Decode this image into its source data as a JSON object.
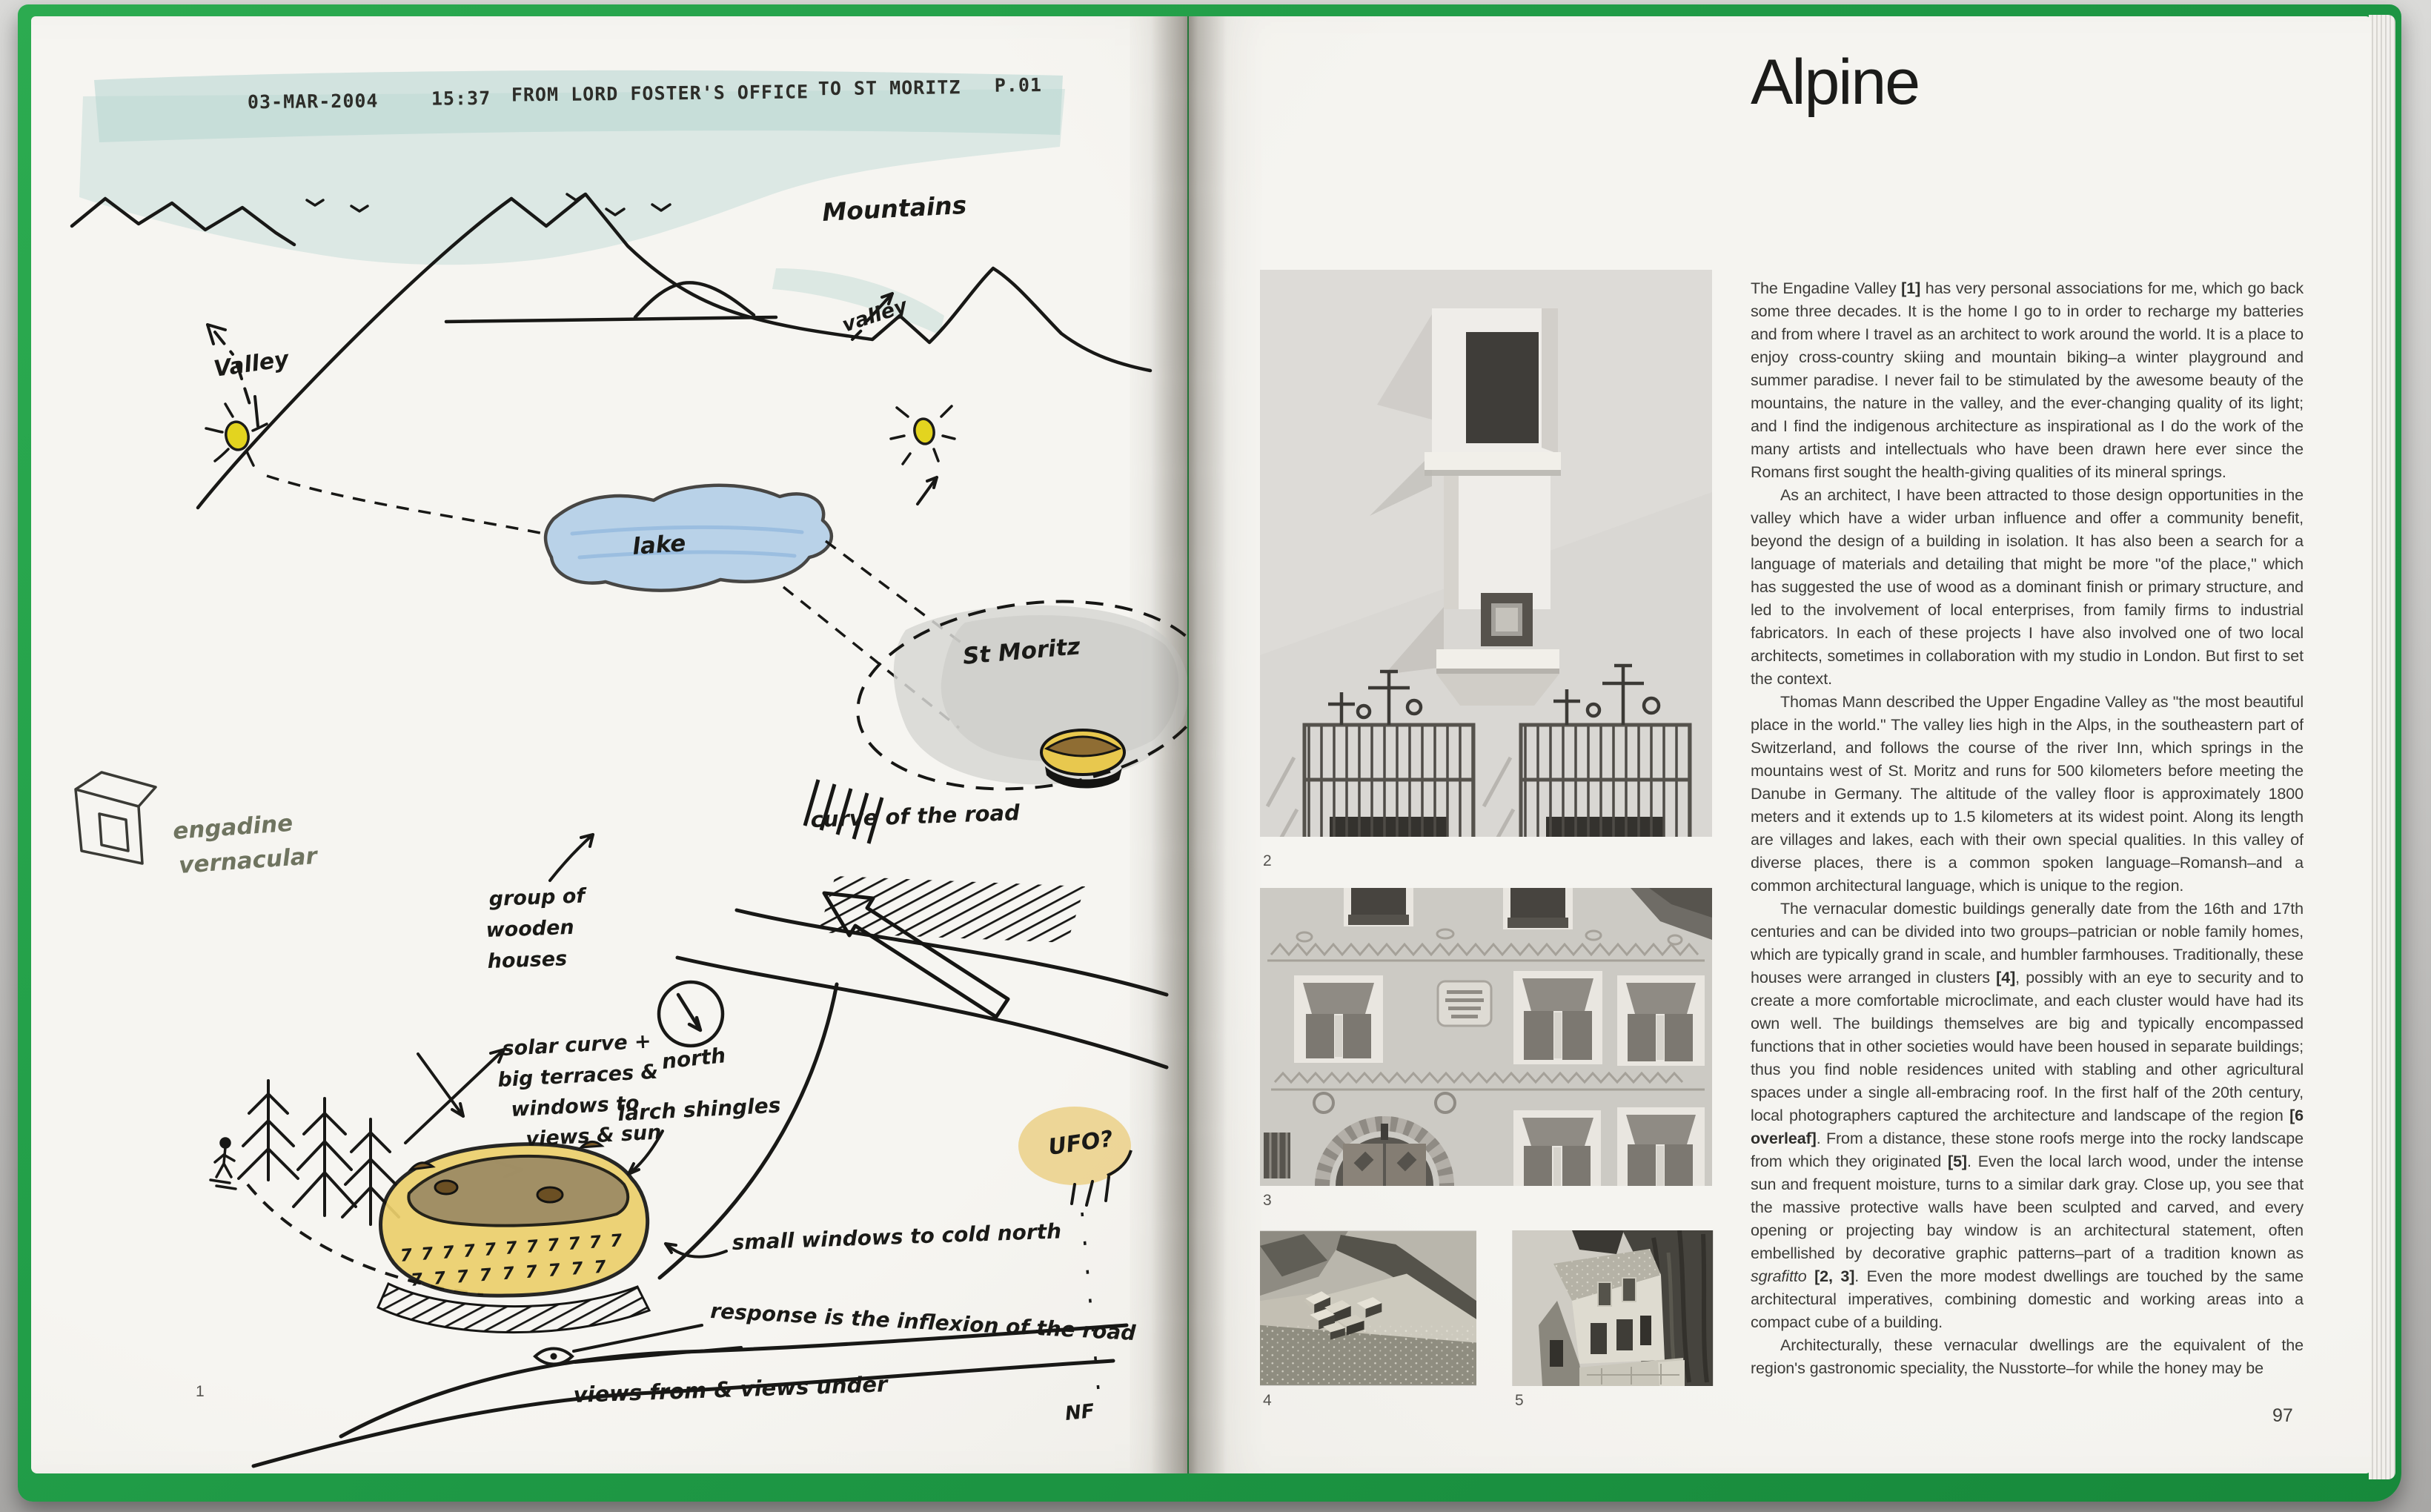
{
  "book": {
    "colors": {
      "cover_green": "#1f9a46",
      "fax_teal": "#aed2cd",
      "lake_blue": "#a9c9e6",
      "sun_yellow": "#e3d41f",
      "building_yellow": "#ecd06c",
      "ink_black": "#1a1a17",
      "ink_olive": "#6f7460"
    },
    "left_page": {
      "fax_header": {
        "date": "03-MAR-2004",
        "time": "15:37",
        "from": "FROM  LORD FOSTER'S OFFICE",
        "to": "TO  ST MORITZ",
        "page_code": "P.01"
      },
      "sketch_labels": {
        "mountains": "Mountains",
        "valley_right": "valley",
        "valley_left": "Valley",
        "lake": "lake",
        "st_moritz": "St Moritz",
        "engadine_line1": "engadine",
        "engadine_line2": "vernacular",
        "curve_of_road": "curve of the road",
        "group_line1": "group of",
        "group_line2": "wooden",
        "group_line3": "houses",
        "north": "north",
        "solar_line1": "solar curve +",
        "solar_line2": "big terraces &",
        "solar_line3": "windows to",
        "solar_line4": "views & sun",
        "larch": "larch shingles",
        "ufo": "UFO?",
        "small_windows": "small windows to cold north",
        "response": "response is the inflexion of the road",
        "views": "views from & views under",
        "initials": "NF",
        "window_marks_row1": "7 7 7 7 7 7 7 7 7 7 7",
        "window_marks_row2": "7 7 7 7 7 7 7 7 7"
      },
      "figure_number": "1"
    },
    "right_page": {
      "title": "Alpine",
      "figures": [
        {
          "number": "2"
        },
        {
          "number": "3"
        },
        {
          "number": "4"
        },
        {
          "number": "5"
        }
      ],
      "page_number": "97",
      "article": {
        "paragraphs": [
          [
            {
              "t": "The Engadine Valley "
            },
            {
              "t": "[1]",
              "b": true
            },
            {
              "t": " has very personal associations for me, which go back some three decades. It is the home I go to in order to recharge my batteries and from where I travel as an architect to work around the world. It is a place to enjoy cross-country skiing and mountain biking–a winter playground and summer paradise. I never fail to be stimulated by the awesome beauty of the mountains, the nature in the valley, and the ever-changing quality of its light; and I find the indigenous architecture as inspirational as I do the work of the many artists and intellectuals who have been drawn here ever since the Romans first sought the health-giving qualities of its mineral springs."
            }
          ],
          [
            {
              "t": "As an architect, I have been attracted to those design opportunities in the valley which have a wider urban influence and offer a community benefit, beyond the design of a building in isolation. It has also been a search for a language of materials and detailing that might be more \"of the place,\" which has suggested the use of wood as a dominant finish or primary structure, and led to the involvement of local enterprises, from family firms to industrial fabricators. In each of these projects I have also involved one of two local architects, sometimes in collaboration with my studio in London. But first to set the context."
            }
          ],
          [
            {
              "t": "Thomas Mann described the Upper Engadine Valley as \"the most beautiful place in the world.\" The valley lies high in the Alps, in the southeastern part of Switzerland, and follows the course of the river Inn, which springs in the mountains west of St. Moritz and runs for 500 kilometers before meeting the Danube in Germany. The altitude of the valley floor is approximately 1800 meters and it extends up to 1.5 kilometers at its widest point. Along its length are villages and lakes, each with their own special qualities. In this valley of diverse places, there is a common spoken language–Romansh–and a common architectural language, which is unique to the region."
            }
          ],
          [
            {
              "t": "The vernacular domestic buildings generally date from the 16th and 17th centuries and can be divided into two groups–patrician or noble family homes, which are typically grand in scale, and humbler farmhouses. Traditionally, these houses were arranged in clusters "
            },
            {
              "t": "[4]",
              "b": true
            },
            {
              "t": ", possibly with an eye to security and to create a more comfortable microclimate, and each cluster would have had its own well. The buildings themselves are big and typically encompassed functions that in other societies would have been housed in separate buildings; thus you find noble residences united with stabling and other agricultural spaces under a single all-embracing roof. In the first half of the 20th century, local photographers captured the architecture and landscape of the region "
            },
            {
              "t": "[6 overleaf]",
              "b": true
            },
            {
              "t": ". From a distance, these stone roofs merge into the rocky landscape from which they originated "
            },
            {
              "t": "[5]",
              "b": true
            },
            {
              "t": ". Even the local larch wood, under the intense sun and frequent moisture, turns to a similar dark gray. Close up, you see that the massive protective walls have been sculpted and carved, and every opening or projecting bay window is an architectural statement, often embellished by decorative graphic patterns–part of a tradition known as "
            },
            {
              "t": "sgrafitto",
              "i": true
            },
            {
              "t": " "
            },
            {
              "t": "[2, 3]",
              "b": true
            },
            {
              "t": ". Even the more modest dwellings are touched by the same architectural imperatives, combining domestic and working areas into a compact cube of a building."
            }
          ],
          [
            {
              "t": "Architecturally, these vernacular dwellings are the equivalent of the region's gastronomic speciality, the Nusstorte–for while the honey may be"
            }
          ]
        ]
      }
    }
  }
}
